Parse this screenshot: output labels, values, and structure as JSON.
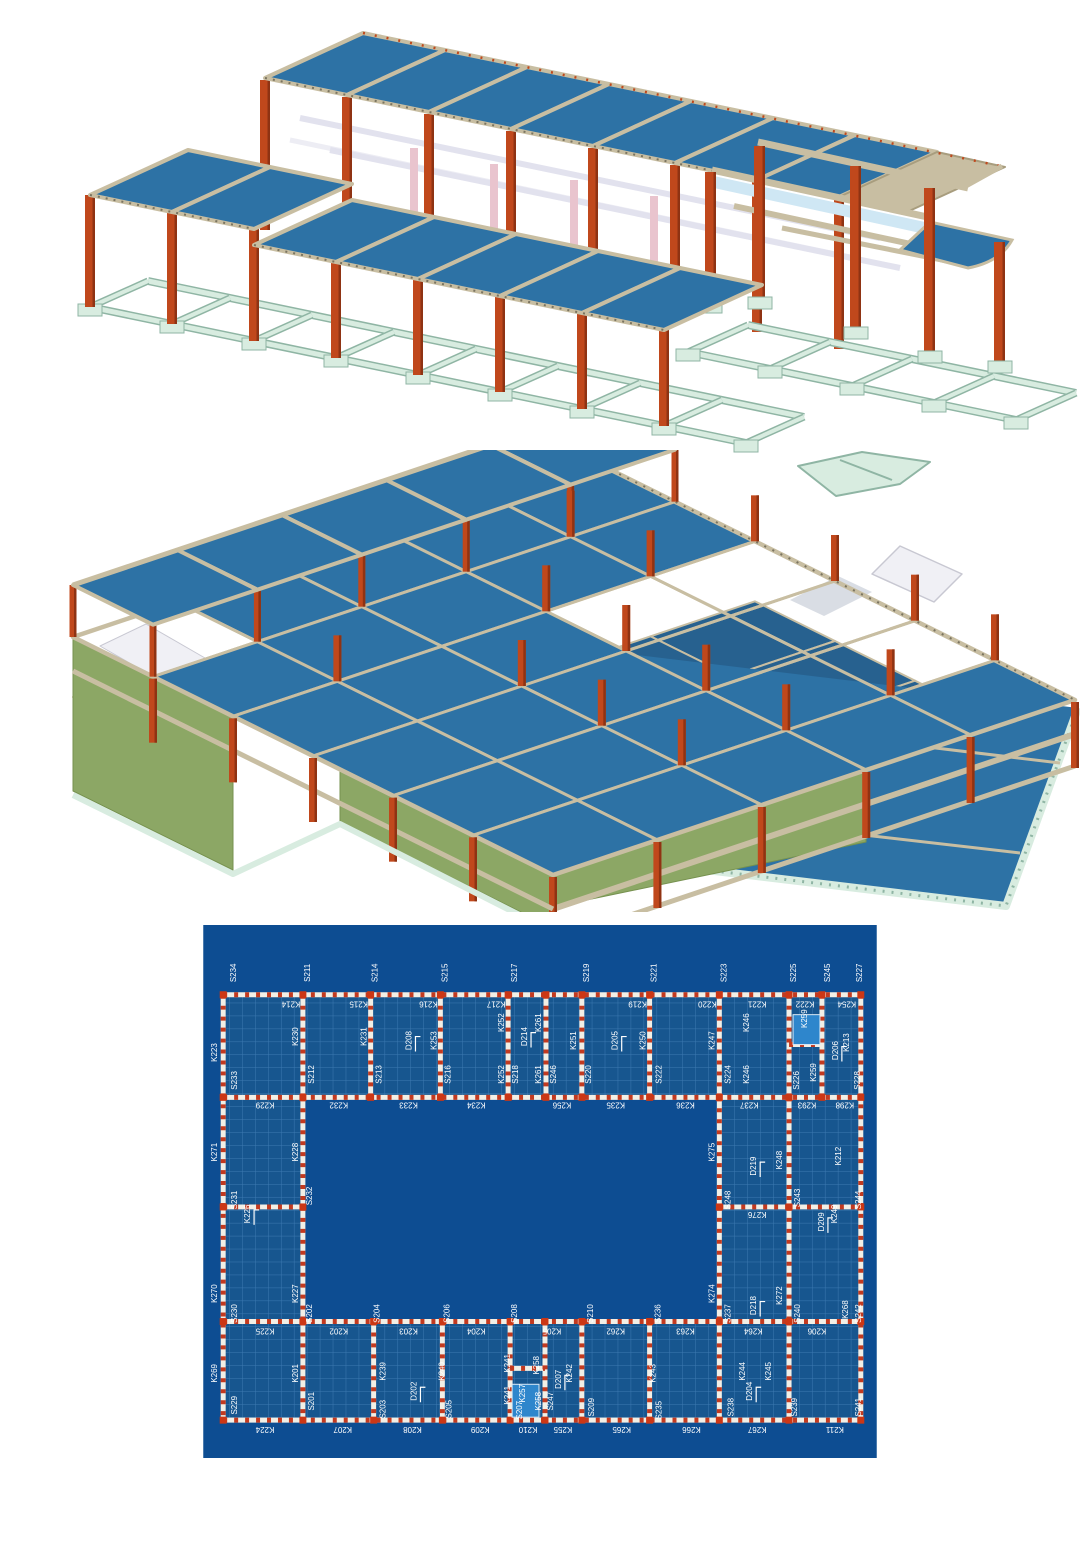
{
  "page": {
    "background": "#ffffff"
  },
  "colors": {
    "slab_blue": "#2d72a5",
    "slab_blue_dark": "#27618f",
    "beam_tan": "#c8bea2",
    "beam_tan_dark": "#a89d7e",
    "column_orange": "#c0481c",
    "column_orange_dark": "#8f3313",
    "foundation_mint": "#d8ece0",
    "foundation_edge": "#8fb5a4",
    "ghost_beam": "#e2e2ee",
    "ghost_pink": "#e9c4ce",
    "wall_olive": "#8ca765",
    "wall_olive_dark": "#76914f",
    "stair_white": "#f0f0f5"
  },
  "plan": {
    "background": "#0d4d92",
    "panel_fill": "#17568f",
    "grid_line": "#3d7ab2",
    "beam_white": "#f2efe6",
    "beam_red": "#c23a20",
    "column_red": "#cc3715",
    "opening_blue": "#2e86cc",
    "label_color": "#ffffff",
    "labels": [
      [
        "S234",
        30,
        48
      ],
      [
        "S211",
        104,
        48
      ],
      [
        "S214",
        172,
        48
      ],
      [
        "S215",
        242,
        48
      ],
      [
        "S217",
        312,
        48
      ],
      [
        "S219",
        384,
        48
      ],
      [
        "S221",
        452,
        48
      ],
      [
        "S223",
        522,
        48
      ],
      [
        "S225",
        592,
        48
      ],
      [
        "S245",
        626,
        48
      ],
      [
        "S227",
        658,
        48
      ],
      [
        "K214",
        88,
        80,
        180
      ],
      [
        "K215",
        156,
        80,
        180
      ],
      [
        "K216",
        226,
        80,
        180
      ],
      [
        "K217",
        294,
        80,
        180
      ],
      [
        "K219",
        436,
        80,
        180
      ],
      [
        "K220",
        506,
        80,
        180
      ],
      [
        "K221",
        556,
        80,
        180
      ],
      [
        "K222",
        604,
        80,
        180
      ],
      [
        "K254",
        646,
        80,
        180
      ],
      [
        "K223",
        11,
        128
      ],
      [
        "K230",
        92,
        112
      ],
      [
        "S233",
        31,
        156
      ],
      [
        "S212",
        108,
        150
      ],
      [
        "K231",
        161,
        112
      ],
      [
        "S213",
        176,
        150
      ],
      [
        "D208",
        206,
        116,
        -90,
        1
      ],
      [
        "K253",
        231,
        116
      ],
      [
        "S216",
        245,
        150
      ],
      [
        "K252",
        299,
        98
      ],
      [
        "K252",
        299,
        150
      ],
      [
        "S218",
        313,
        150
      ],
      [
        "D214",
        322,
        112,
        -90,
        1
      ],
      [
        "K261",
        336,
        98
      ],
      [
        "K261",
        336,
        150
      ],
      [
        "S246",
        351,
        150
      ],
      [
        "K251",
        371,
        116
      ],
      [
        "S220",
        386,
        150
      ],
      [
        "D205",
        413,
        116,
        -90,
        1
      ],
      [
        "K250",
        441,
        116
      ],
      [
        "S222",
        457,
        150
      ],
      [
        "K247",
        510,
        116
      ],
      [
        "S224",
        526,
        150
      ],
      [
        "K246",
        545,
        98
      ],
      [
        "K246",
        545,
        150
      ],
      [
        "K259",
        603,
        94
      ],
      [
        "S226",
        595,
        156
      ],
      [
        "K259",
        612,
        148
      ],
      [
        "D206",
        634,
        126,
        -90,
        1
      ],
      [
        "K213",
        645,
        118
      ],
      [
        "S228",
        656,
        156
      ],
      [
        "K229",
        62,
        181,
        180
      ],
      [
        "K232",
        136,
        181,
        180
      ],
      [
        "K233",
        206,
        181,
        180
      ],
      [
        "K234",
        274,
        181,
        180
      ],
      [
        "K256",
        360,
        181,
        180
      ],
      [
        "K235",
        414,
        181,
        180
      ],
      [
        "K236",
        484,
        181,
        180
      ],
      [
        "K237",
        548,
        181,
        180
      ],
      [
        "K293",
        606,
        181,
        180
      ],
      [
        "K298",
        644,
        181,
        180
      ],
      [
        "K271",
        11,
        228
      ],
      [
        "K228",
        92,
        228
      ],
      [
        "S231",
        31,
        276
      ],
      [
        "S232",
        106,
        272
      ],
      [
        "K226",
        44,
        290,
        -90,
        1
      ],
      [
        "K270",
        11,
        370
      ],
      [
        "K227",
        92,
        370
      ],
      [
        "S230",
        31,
        390
      ],
      [
        "K275",
        510,
        228
      ],
      [
        "D219",
        552,
        242,
        -90,
        1
      ],
      [
        "K248",
        578,
        236
      ],
      [
        "S248",
        526,
        276
      ],
      [
        "S243",
        596,
        274
      ],
      [
        "K212",
        637,
        232
      ],
      [
        "S244",
        657,
        276
      ],
      [
        "K276",
        556,
        291,
        180
      ],
      [
        "D209",
        620,
        298,
        -90,
        1
      ],
      [
        "K249",
        633,
        290
      ],
      [
        "K274",
        510,
        370
      ],
      [
        "D218",
        552,
        382,
        -90,
        1
      ],
      [
        "K272",
        578,
        372
      ],
      [
        "S237",
        526,
        390
      ],
      [
        "S240",
        596,
        390
      ],
      [
        "K268",
        644,
        386
      ],
      [
        "S242",
        657,
        390
      ],
      [
        "S202",
        106,
        390
      ],
      [
        "S204",
        174,
        390
      ],
      [
        "S206",
        244,
        390
      ],
      [
        "S208",
        312,
        390
      ],
      [
        "S210",
        388,
        390
      ],
      [
        "S236",
        456,
        390
      ],
      [
        "K225",
        62,
        408,
        180
      ],
      [
        "K202",
        136,
        408,
        180
      ],
      [
        "K203",
        206,
        408,
        180
      ],
      [
        "K204",
        274,
        408,
        180
      ],
      [
        "K205",
        350,
        408,
        180
      ],
      [
        "K262",
        414,
        408,
        180
      ],
      [
        "K263",
        484,
        408,
        180
      ],
      [
        "K264",
        552,
        408,
        180
      ],
      [
        "K206",
        616,
        408,
        180
      ],
      [
        "K269",
        11,
        450
      ],
      [
        "K201",
        92,
        450
      ],
      [
        "S229",
        31,
        482
      ],
      [
        "S201",
        108,
        478
      ],
      [
        "K239",
        180,
        448
      ],
      [
        "D202",
        211,
        468,
        -90,
        1
      ],
      [
        "K240",
        239,
        448
      ],
      [
        "S203",
        180,
        486
      ],
      [
        "S205",
        246,
        486
      ],
      [
        "K241",
        305,
        440
      ],
      [
        "K241",
        305,
        472
      ],
      [
        "K258",
        334,
        442
      ],
      [
        "K257",
        320,
        470
      ],
      [
        "S207",
        317,
        487
      ],
      [
        "K258",
        336,
        478
      ],
      [
        "S247",
        348,
        478
      ],
      [
        "D207",
        356,
        456,
        -90,
        1
      ],
      [
        "K242",
        367,
        450
      ],
      [
        "S209",
        389,
        484
      ],
      [
        "K243",
        451,
        450
      ],
      [
        "S235",
        457,
        487
      ],
      [
        "S238",
        529,
        484
      ],
      [
        "K244",
        541,
        448
      ],
      [
        "D204",
        548,
        468,
        -90,
        1
      ],
      [
        "K245",
        567,
        448
      ],
      [
        "S239",
        593,
        484
      ],
      [
        "S241",
        657,
        484
      ],
      [
        "K224",
        62,
        507,
        180
      ],
      [
        "K207",
        140,
        507,
        180
      ],
      [
        "K208",
        210,
        507,
        180
      ],
      [
        "K209",
        278,
        507,
        180
      ],
      [
        "K210",
        326,
        507,
        180
      ],
      [
        "K255",
        361,
        507,
        180
      ],
      [
        "K265",
        420,
        507,
        180
      ],
      [
        "K266",
        490,
        507,
        180
      ],
      [
        "K267",
        556,
        507,
        180
      ],
      [
        "K211",
        634,
        507,
        180
      ]
    ]
  }
}
